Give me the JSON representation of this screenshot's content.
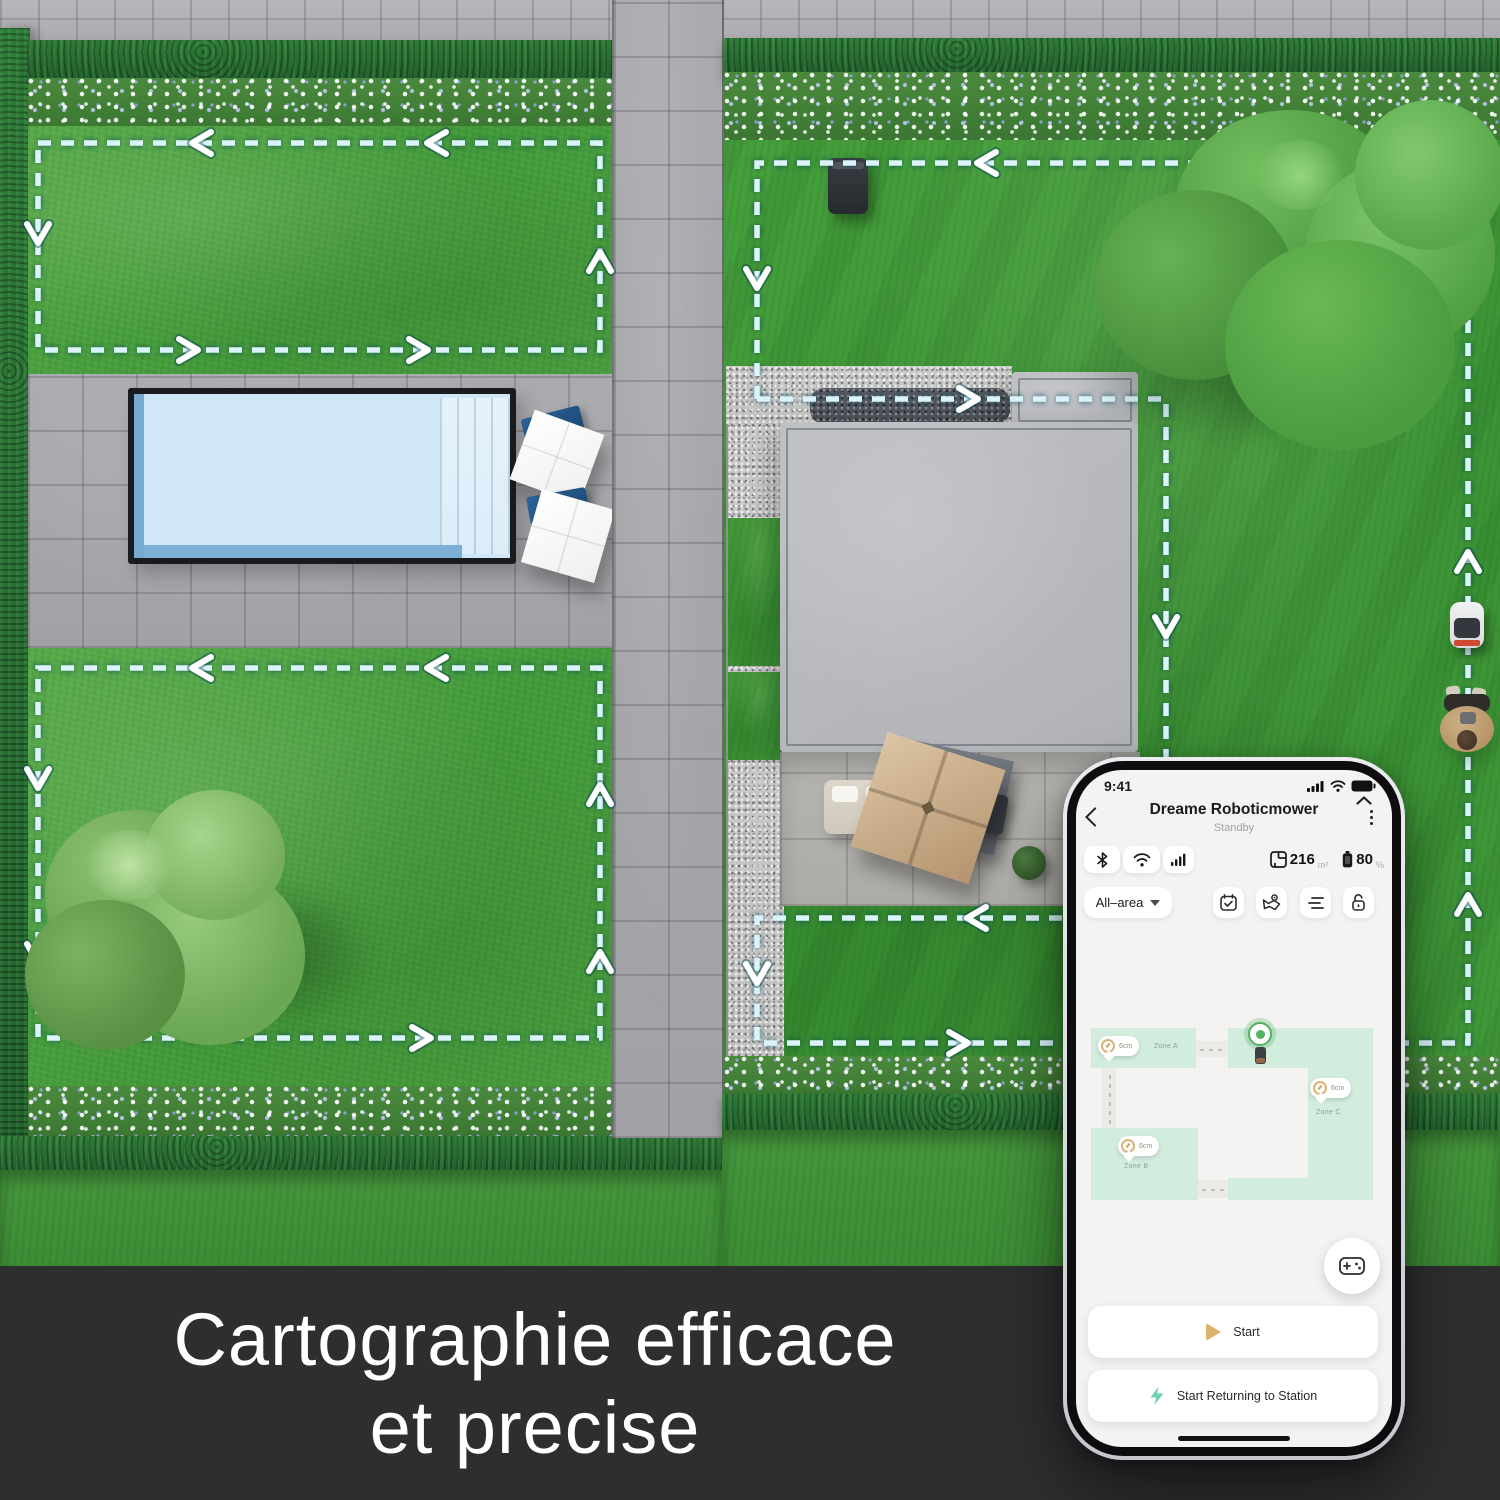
{
  "banner": {
    "line1": "Cartographie efficace",
    "line2": "et precise",
    "bg_color": "#2d2e30",
    "text_color": "#ffffff"
  },
  "phone": {
    "status": {
      "time": "9:41"
    },
    "header": {
      "title": "Dreame Roboticmower",
      "subtitle": "Standby"
    },
    "stats": {
      "area": "216",
      "area_unit": "m²",
      "battery": "80",
      "battery_unit": "%"
    },
    "area_selector": {
      "label": "All–area"
    },
    "map": {
      "zones": [
        {
          "label": "Zone A",
          "badge": "6cm"
        },
        {
          "label": "Zone B",
          "badge": "6cm"
        },
        {
          "label": "Zone C",
          "badge": "6cm"
        }
      ]
    },
    "buttons": {
      "start": "Start",
      "return": "Start Returning to Station"
    },
    "accent_colors": {
      "play_icon": "#dcb36d",
      "bolt_icon": "#6fd3b2",
      "zone_fill": "#d2ecde",
      "station_green": "#54b161",
      "path_dash": "#dbf4fc"
    }
  }
}
